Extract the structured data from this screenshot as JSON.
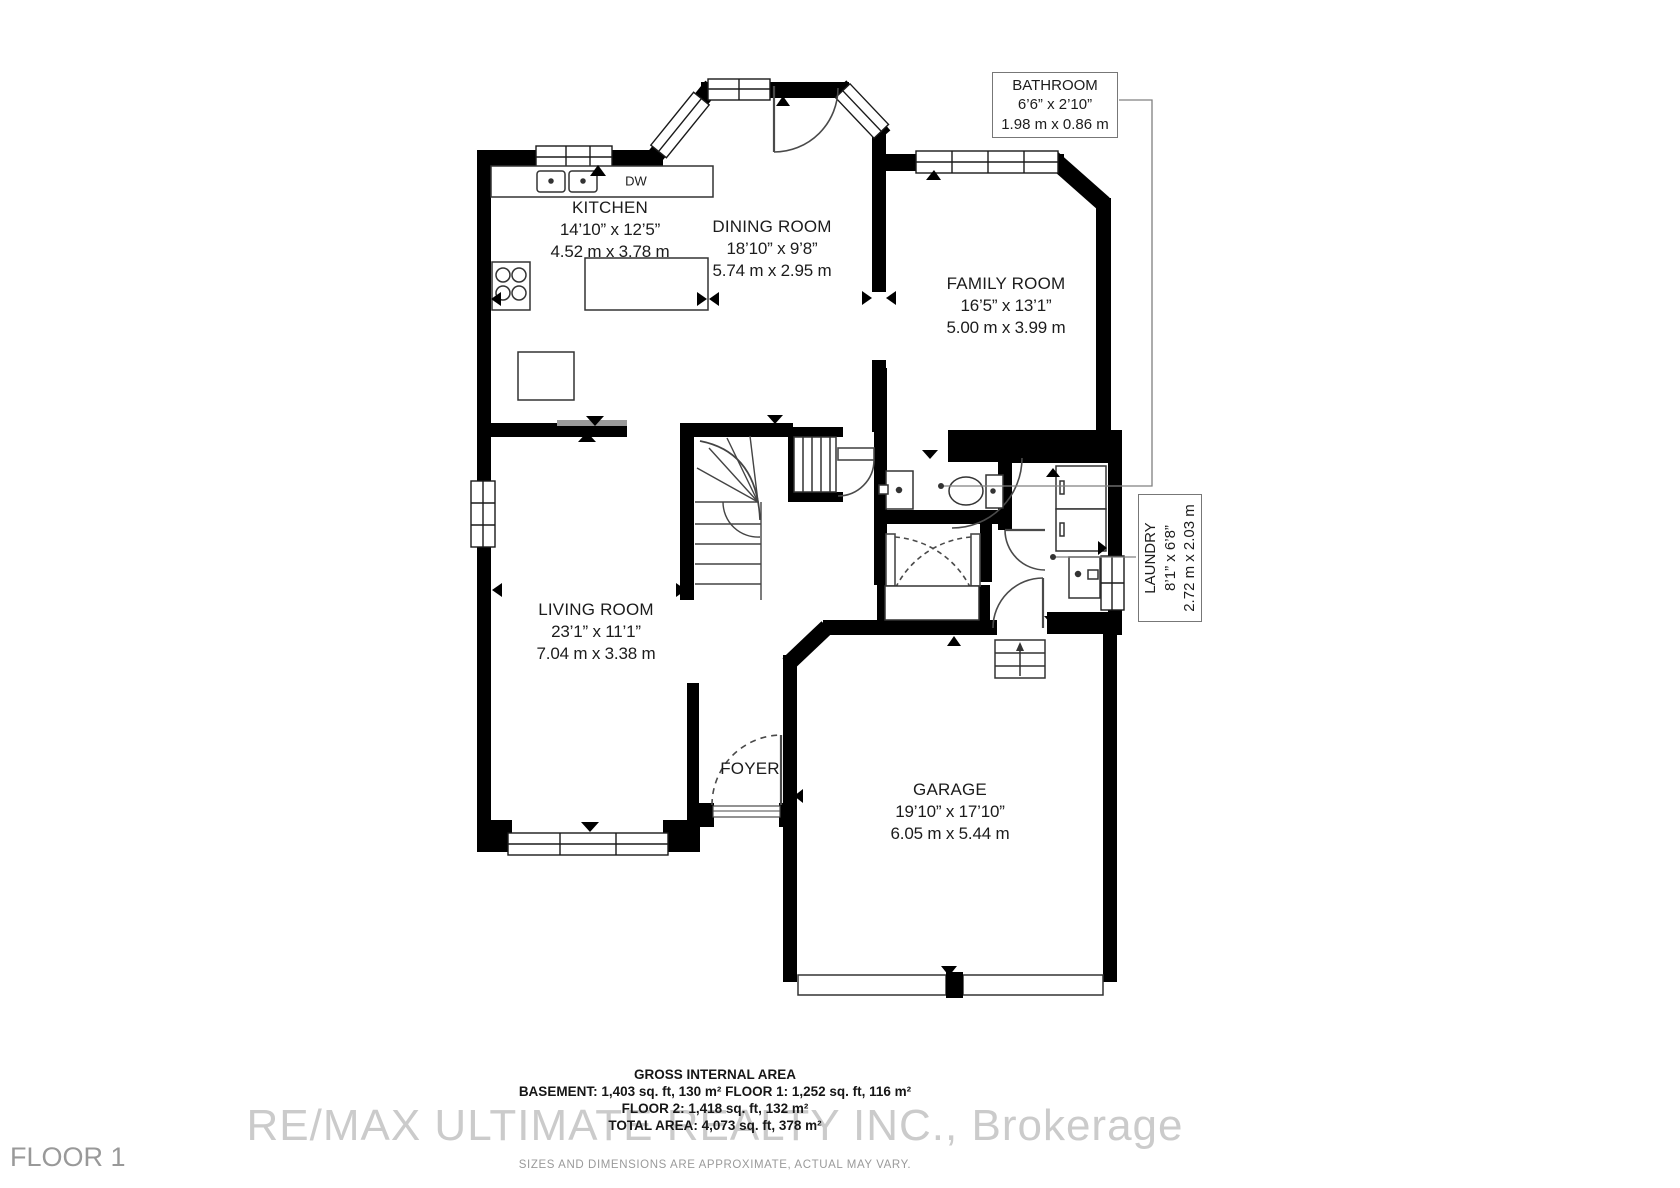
{
  "plan": {
    "floor_label": "FLOOR 1",
    "rooms": {
      "kitchen": {
        "name": "KITCHEN",
        "imperial": "14’10” x 12’5”",
        "metric": "4.52 m x 3.78 m"
      },
      "dining_room": {
        "name": "DINING ROOM",
        "imperial": "18’10” x 9’8”",
        "metric": "5.74 m x 2.95 m"
      },
      "family_room": {
        "name": "FAMILY ROOM",
        "imperial": "16’5” x 13’1”",
        "metric": "5.00 m x 3.99 m"
      },
      "living_room": {
        "name": "LIVING ROOM",
        "imperial": "23’1” x 11’1”",
        "metric": "7.04 m x 3.38 m"
      },
      "garage": {
        "name": "GARAGE",
        "imperial": "19’10” x 17’10”",
        "metric": "6.05 m x 5.44 m"
      },
      "foyer": {
        "name": "FOYER"
      }
    },
    "callouts": {
      "bathroom": {
        "name": "BATHROOM",
        "imperial": "6’6” x 2’10”",
        "metric": "1.98 m x 0.86 m"
      },
      "laundry": {
        "name": "LAUNDRY",
        "imperial": "8’1” x 6’8”",
        "metric": "2.72 m x 2.03 m"
      }
    },
    "fixtures": {
      "dishwasher_label": "DW"
    }
  },
  "footer": {
    "title": "GROSS INTERNAL AREA",
    "areas_line_1": "BASEMENT: 1,403 sq. ft, 130 m² FLOOR 1: 1,252 sq. ft, 116 m²",
    "areas_line_2": "FLOOR 2: 1,418 sq. ft, 132 m²",
    "areas_line_3": "TOTAL AREA: 4,073 sq. ft, 378 m²",
    "disclaimer": "SIZES AND DIMENSIONS ARE APPROXIMATE, ACTUAL MAY VARY."
  },
  "watermark": "RE/MAX ULTIMATE REALTY INC., Brokerage",
  "colors": {
    "wall": "#000000",
    "label_text": "#1c1c1c",
    "muted_text": "#9a9a9a",
    "watermark_text": "#cbcbcb"
  }
}
